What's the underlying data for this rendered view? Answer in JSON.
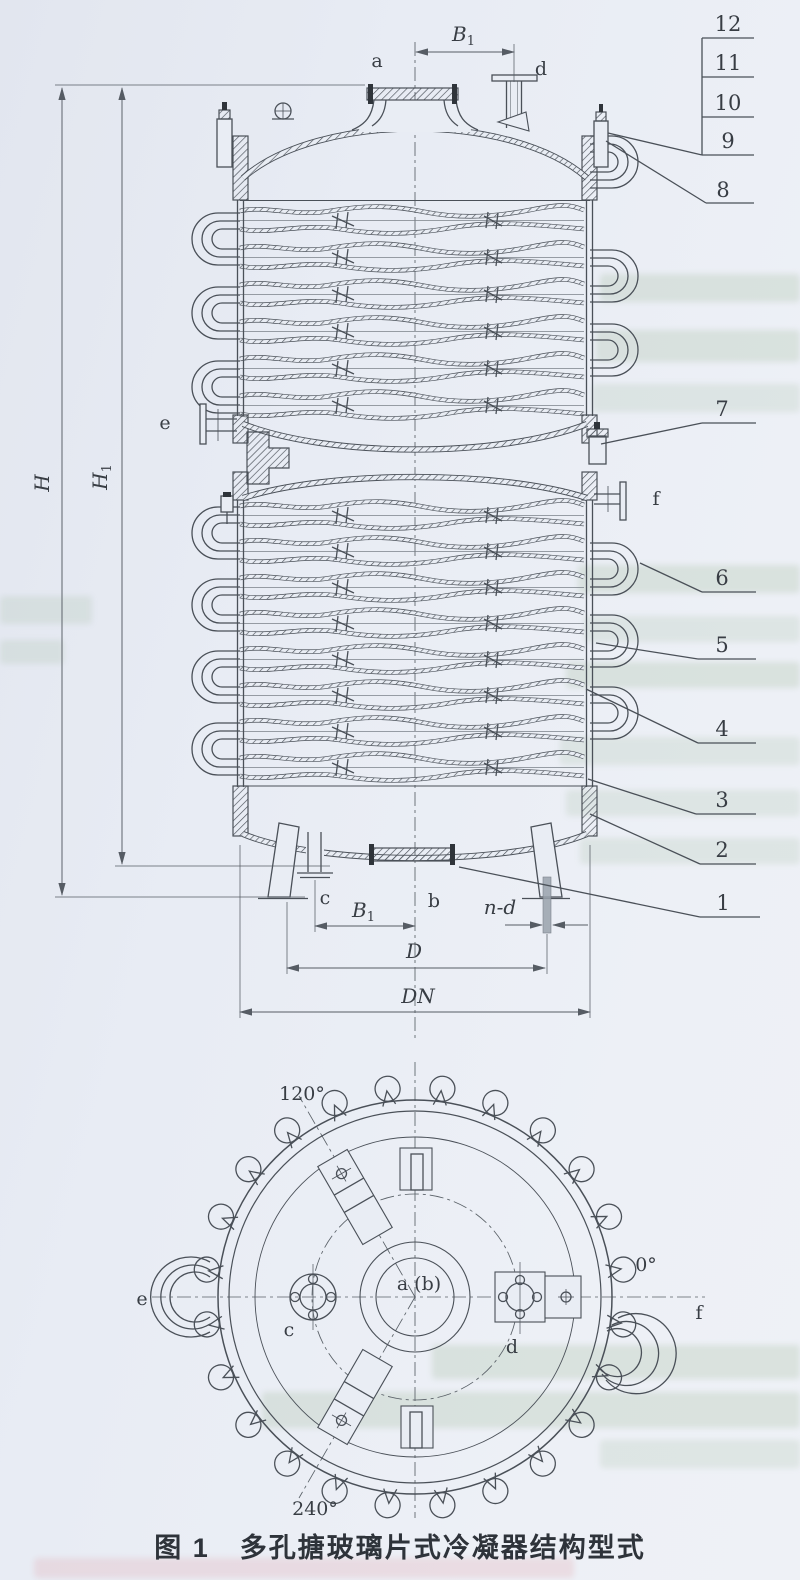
{
  "caption": {
    "fig": "图 1",
    "title": "多孔搪玻璃片式冷凝器结构型式"
  },
  "front_view": {
    "callouts_ladder": [
      "12",
      "11",
      "10",
      "9"
    ],
    "callouts_side": [
      "8",
      "7",
      "6",
      "5",
      "4",
      "3",
      "2",
      "1"
    ],
    "dimensions": {
      "b1_top": {
        "letter": "B",
        "sub": "1"
      },
      "h": {
        "letter": "H",
        "sub": ""
      },
      "h1": {
        "letter": "H",
        "sub": "1"
      },
      "b1_bottom": {
        "letter": "B",
        "sub": "1"
      },
      "nd": "n-d",
      "d": "D",
      "dn": "DN"
    },
    "nozzles": {
      "a": "a",
      "b": "b",
      "c": "c",
      "d": "d",
      "e": "e",
      "f": "f"
    }
  },
  "plan_view": {
    "angle_120": "120°",
    "angle_0": "0°",
    "angle_240": "240°",
    "center": "a (b)",
    "c": "c",
    "d": "d",
    "e": "e",
    "f": "f"
  },
  "colors": {
    "line": "#4a5058",
    "paper": "#e9edf4"
  }
}
